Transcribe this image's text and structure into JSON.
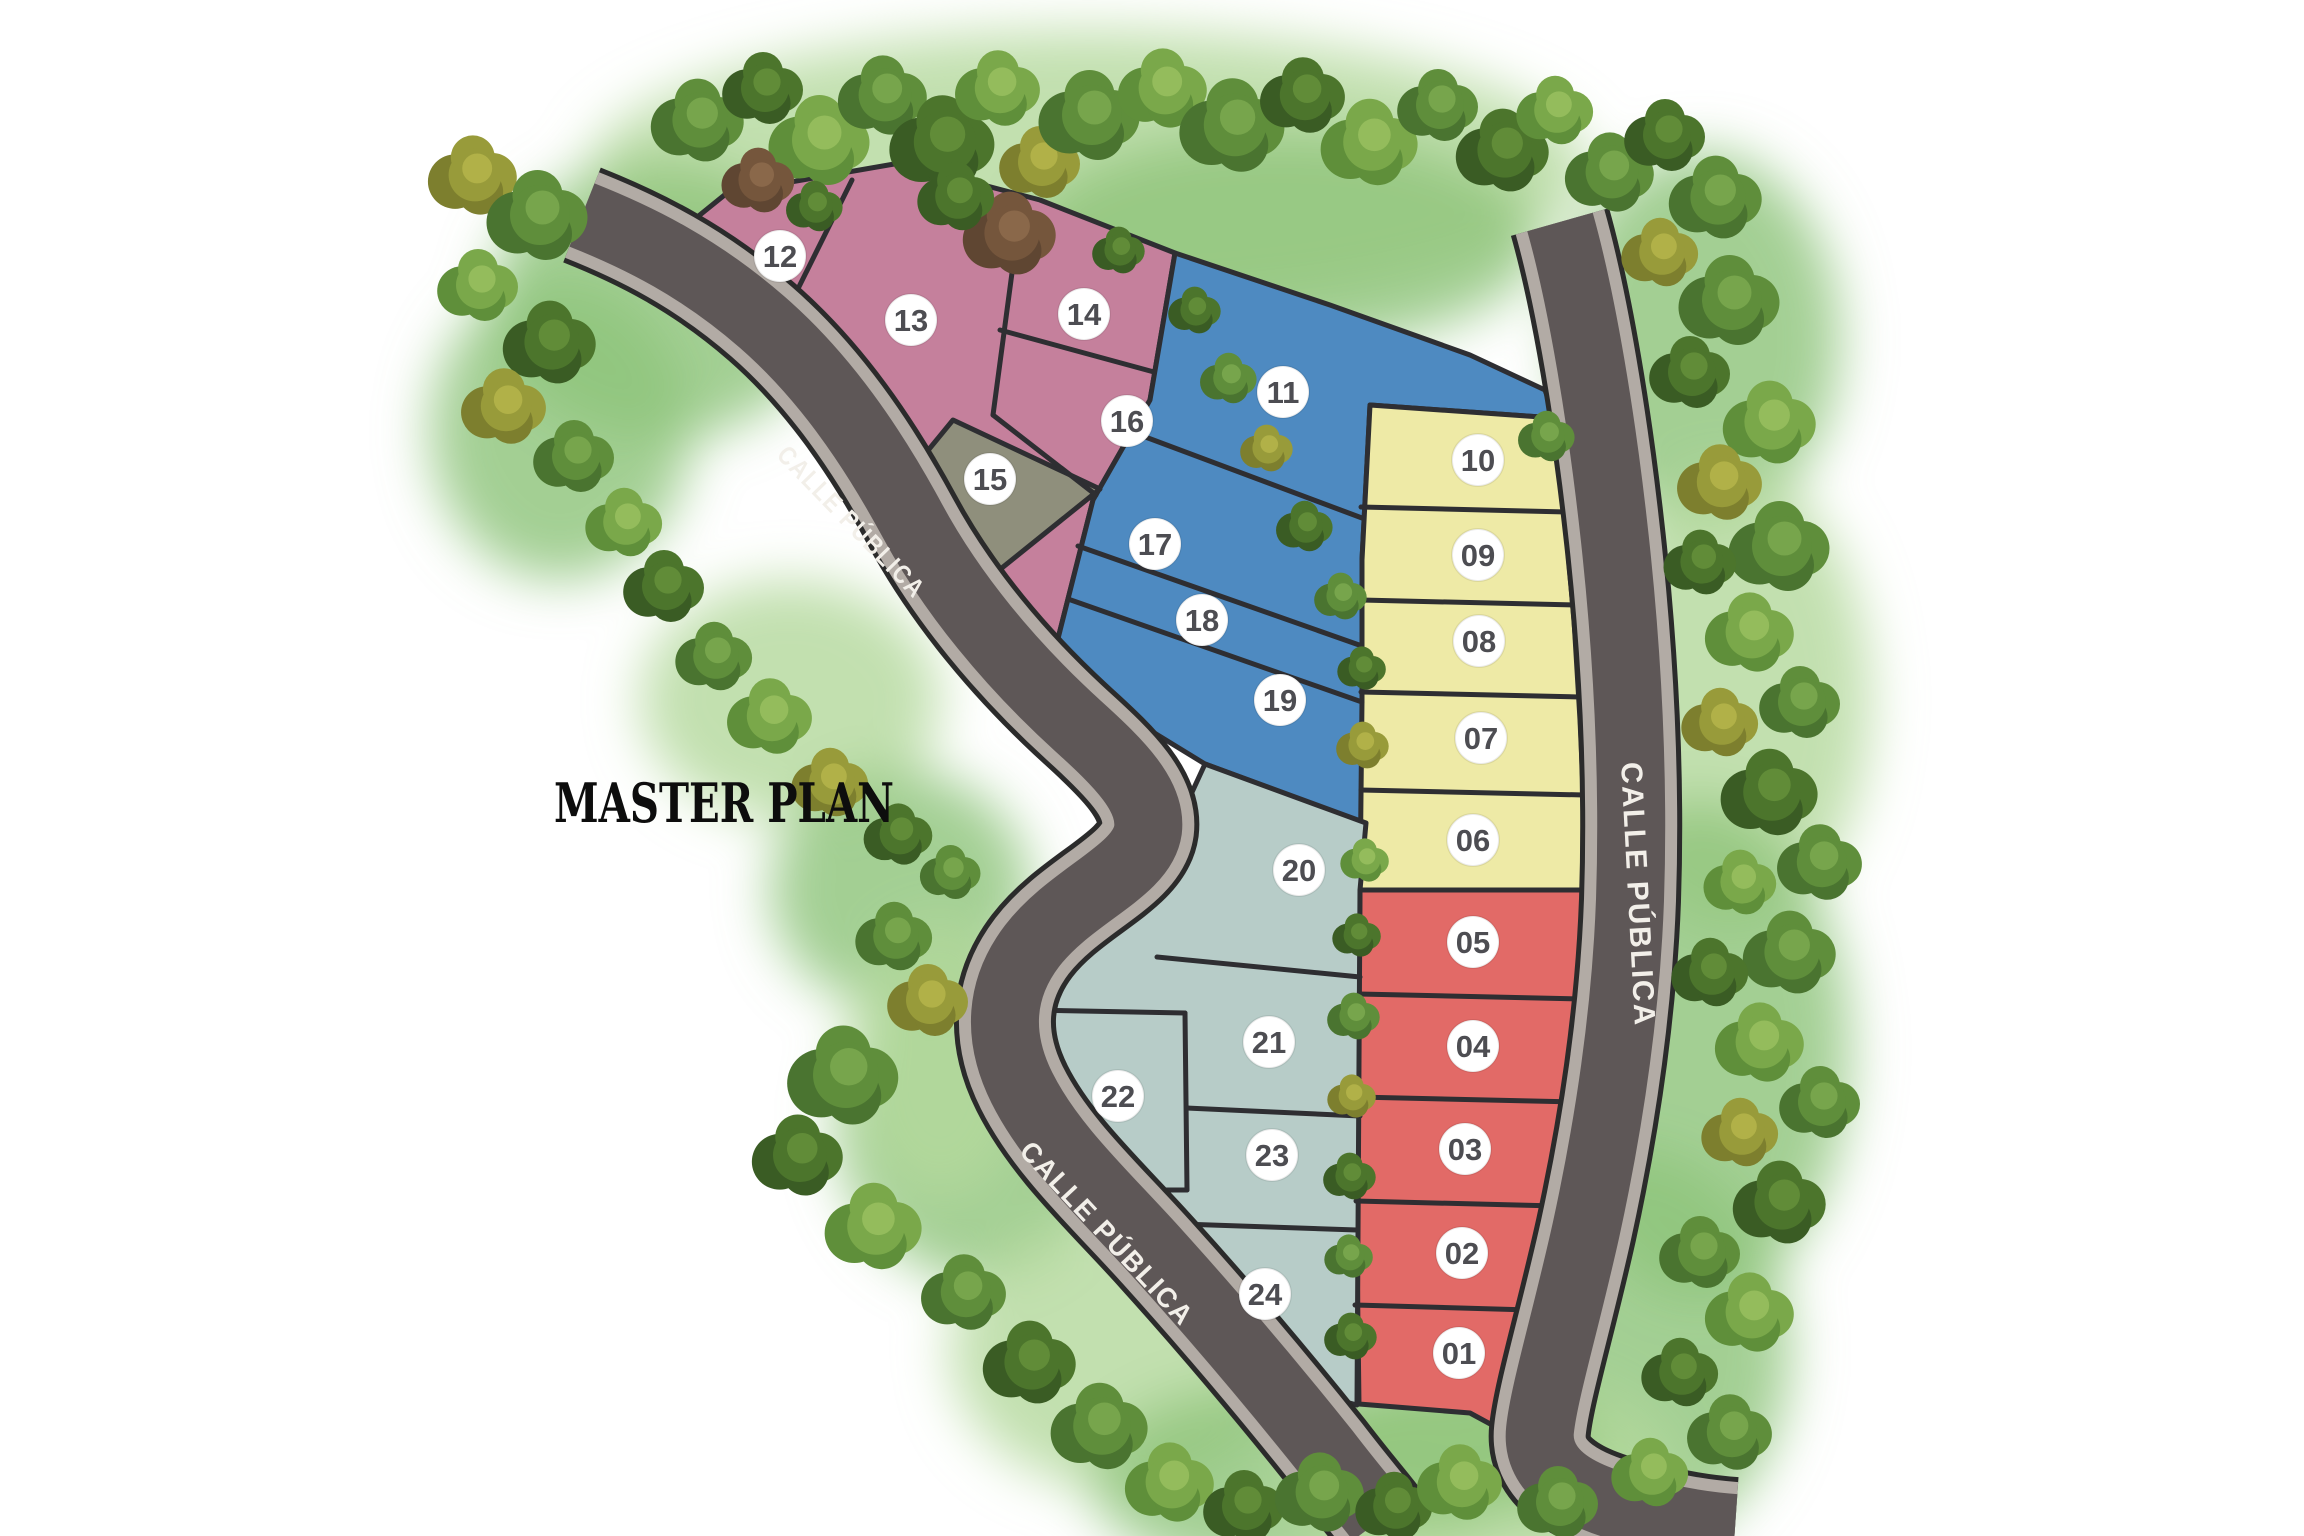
{
  "title": "MASTER PLAN",
  "road_labels": [
    {
      "text": "CALLE PÚBLICA",
      "x": 845,
      "y": 528,
      "rotation": 46,
      "size": 26,
      "length": 200
    },
    {
      "text": "CALLE PÚBLICA",
      "x": 1100,
      "y": 1240,
      "rotation": 47,
      "size": 28,
      "length": 240
    },
    {
      "text": "CALLE PÚBLICA",
      "x": 1628,
      "y": 895,
      "rotation": 87,
      "size": 30,
      "length": 265
    }
  ],
  "colors": {
    "pink": "#c5809c",
    "olive": "#8f8f7c",
    "blue": "#4e8ac1",
    "yellow": "#eeeaa6",
    "red": "#e26a67",
    "teal": "#b7ccc8",
    "road_asphalt": "#5e5757",
    "road_edge": "#b2aba5",
    "outline": "#2e2e32",
    "circle_fill": "#ffffff",
    "number_color": "#4d4d52",
    "label_color": "#f2efe9",
    "title_color": "#0d0d0d",
    "halo_green": "#8fc47b",
    "halo_green_light": "#b5d99e"
  },
  "lots": [
    {
      "number": "01",
      "group": "red",
      "cx": 1459,
      "cy": 1353
    },
    {
      "number": "02",
      "group": "red",
      "cx": 1462,
      "cy": 1253
    },
    {
      "number": "03",
      "group": "red",
      "cx": 1465,
      "cy": 1149
    },
    {
      "number": "04",
      "group": "red",
      "cx": 1473,
      "cy": 1046
    },
    {
      "number": "05",
      "group": "red",
      "cx": 1473,
      "cy": 942
    },
    {
      "number": "06",
      "group": "yellow",
      "cx": 1473,
      "cy": 840
    },
    {
      "number": "07",
      "group": "yellow",
      "cx": 1481,
      "cy": 738
    },
    {
      "number": "08",
      "group": "yellow",
      "cx": 1479,
      "cy": 641
    },
    {
      "number": "09",
      "group": "yellow",
      "cx": 1478,
      "cy": 555
    },
    {
      "number": "10",
      "group": "yellow",
      "cx": 1478,
      "cy": 460
    },
    {
      "number": "11",
      "group": "blue",
      "cx": 1283,
      "cy": 392
    },
    {
      "number": "12",
      "group": "pink",
      "cx": 780,
      "cy": 256
    },
    {
      "number": "13",
      "group": "pink",
      "cx": 911,
      "cy": 320
    },
    {
      "number": "14",
      "group": "pink",
      "cx": 1084,
      "cy": 314
    },
    {
      "number": "15",
      "group": "olive",
      "cx": 990,
      "cy": 479
    },
    {
      "number": "16",
      "group": "pink",
      "cx": 1127,
      "cy": 421
    },
    {
      "number": "17",
      "group": "blue",
      "cx": 1155,
      "cy": 544
    },
    {
      "number": "18",
      "group": "blue",
      "cx": 1202,
      "cy": 620
    },
    {
      "number": "19",
      "group": "blue",
      "cx": 1280,
      "cy": 700
    },
    {
      "number": "20",
      "group": "teal",
      "cx": 1299,
      "cy": 870
    },
    {
      "number": "21",
      "group": "teal",
      "cx": 1269,
      "cy": 1042
    },
    {
      "number": "22",
      "group": "teal",
      "cx": 1118,
      "cy": 1096
    },
    {
      "number": "23",
      "group": "teal",
      "cx": 1272,
      "cy": 1155
    },
    {
      "number": "24",
      "group": "teal",
      "cx": 1265,
      "cy": 1294
    }
  ]
}
